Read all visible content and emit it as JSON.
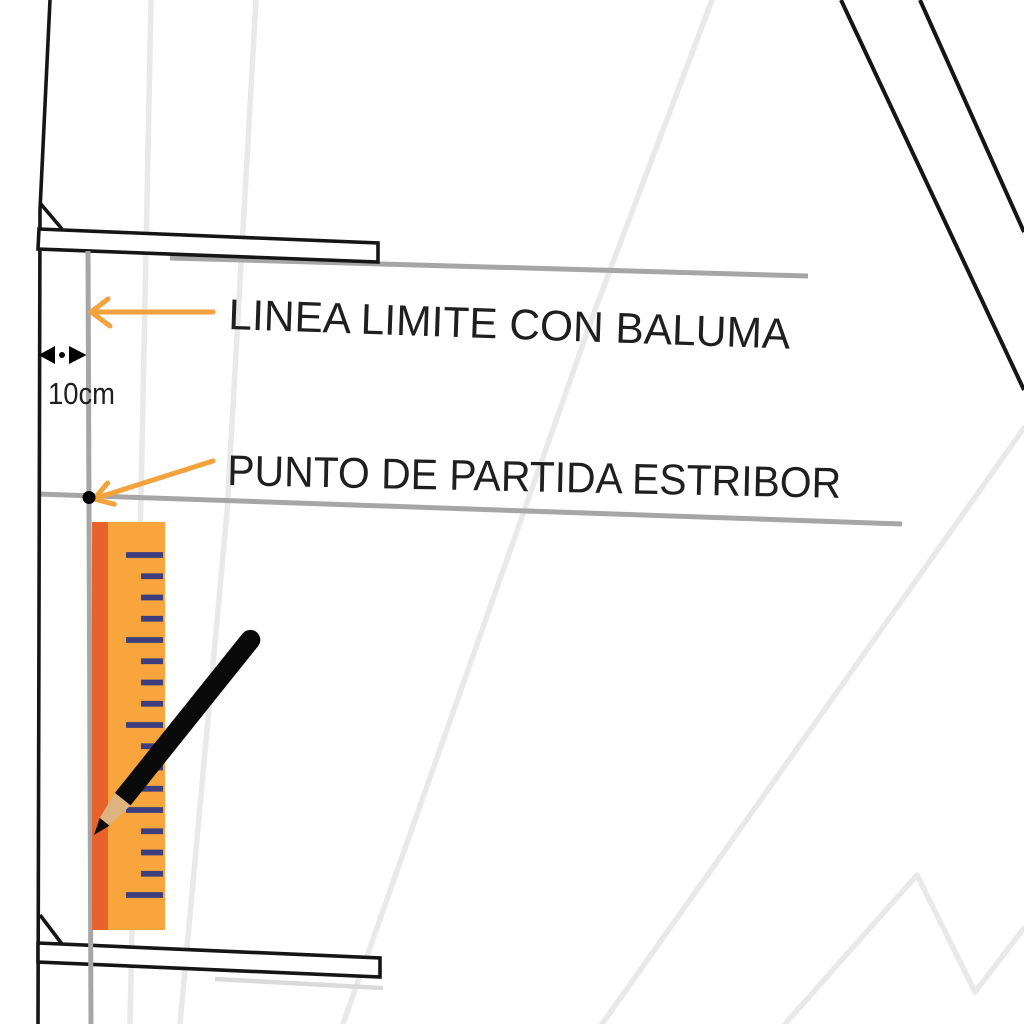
{
  "labels": {
    "limit_line": "LINEA LIMITE CON BALUMA",
    "start_point": "PUNTO DE PARTIDA ESTRIBOR",
    "gap_measurement": "10cm"
  },
  "icons": [
    "left-arrow-icon",
    "down-left-arrow-icon",
    "double-arrow-icon",
    "pencil-icon",
    "start-point-dot"
  ],
  "colors": {
    "outline_black": "#151515",
    "guide_gray": "#A6A6A6",
    "crease_gray": "#E9E9E9",
    "shadow_gray": "#DADADA",
    "arrow_orange": "#F4A23E",
    "ruler_body": "#F7A53C",
    "ruler_stripe": "#E8632C",
    "ruler_tick": "#3E3E7E",
    "pencil_body": "#0A0A0A",
    "pencil_wood": "#DDB380",
    "text_black": "#1F1F1F",
    "dot_black": "#000000"
  },
  "ruler": {
    "first_tick_y": 555,
    "tick_spacing": 21.25,
    "tick_count": 17,
    "long_every": 4,
    "long_tick_x": 126,
    "short_tick_x": 141,
    "tick_end_x": 163
  }
}
